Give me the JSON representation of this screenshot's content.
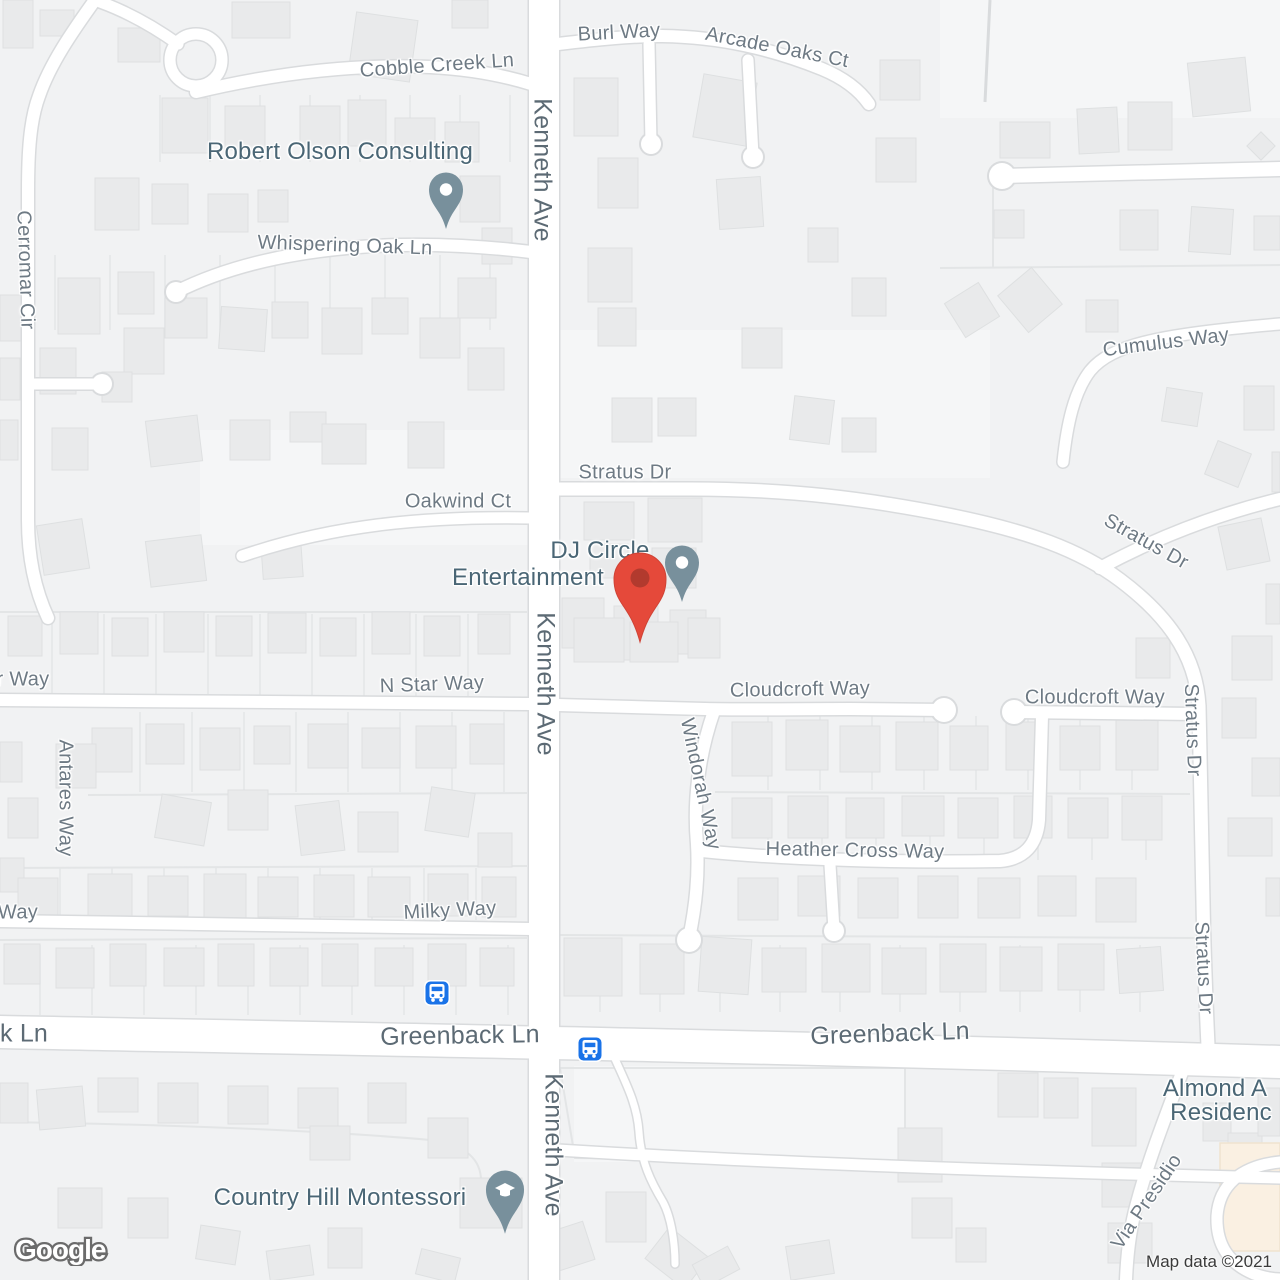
{
  "map": {
    "attribution": "Map data ©2021",
    "google_logo": "Google",
    "colors": {
      "land": "#f1f2f3",
      "light_block": "#f5f6f7",
      "road_fill": "#ffffff",
      "road_casing": "#d9dbdd",
      "parcel_line": "#e3e5e6",
      "building_fill": "#e9eaeb",
      "building_stroke": "#dee0e1",
      "commercial_fill": "#faf0e2",
      "commercial_stroke": "#f0e3cf",
      "street_label": "#6e7a84",
      "arterial_label": "#5c6a74",
      "poi_label": "#4a6675",
      "poi_pin": "#78909c",
      "red_marker": "#e5493a",
      "red_marker_inner": "#b23a2e",
      "transit_blue": "#1a73e8",
      "attribution_text": "#3a3a3a"
    },
    "street_labels": [
      {
        "text": "Burl Way",
        "x": 619,
        "y": 33,
        "rot": -3,
        "kind": "minor"
      },
      {
        "text": "Arcade Oaks Ct",
        "x": 777,
        "y": 48,
        "rot": 11,
        "kind": "minor"
      },
      {
        "text": "Cobble Creek Ln",
        "x": 437,
        "y": 66,
        "rot": -4,
        "kind": "minor"
      },
      {
        "text": "Kenneth Ave",
        "x": 542,
        "y": 170,
        "rot": 90,
        "kind": "major"
      },
      {
        "text": "Cerromar Cir",
        "x": 25,
        "y": 270,
        "rot": 88,
        "kind": "minor"
      },
      {
        "text": "Whispering Oak Ln",
        "x": 345,
        "y": 246,
        "rot": 2,
        "kind": "minor"
      },
      {
        "text": "Cumulus Way",
        "x": 1166,
        "y": 343,
        "rot": -7,
        "kind": "minor"
      },
      {
        "text": "Stratus Dr",
        "x": 625,
        "y": 473,
        "rot": 0,
        "kind": "minor"
      },
      {
        "text": "Oakwind Ct",
        "x": 458,
        "y": 502,
        "rot": 0,
        "kind": "minor"
      },
      {
        "text": "Stratus Dr",
        "x": 1146,
        "y": 542,
        "rot": 29,
        "kind": "minor"
      },
      {
        "text": "Kenneth Ave",
        "x": 545,
        "y": 684,
        "rot": 90,
        "kind": "major"
      },
      {
        "text": "N Star Way",
        "x": 432,
        "y": 685,
        "rot": -2,
        "kind": "minor"
      },
      {
        "text": "r Way",
        "x": 23,
        "y": 680,
        "rot": 0,
        "kind": "minor"
      },
      {
        "text": "Cloudcroft Way",
        "x": 800,
        "y": 690,
        "rot": -1,
        "kind": "minor"
      },
      {
        "text": "Cloudcroft Way",
        "x": 1095,
        "y": 698,
        "rot": 0,
        "kind": "minor"
      },
      {
        "text": "Stratus Dr",
        "x": 1192,
        "y": 730,
        "rot": 88,
        "kind": "minor"
      },
      {
        "text": "Antares Way",
        "x": 65,
        "y": 798,
        "rot": 90,
        "kind": "minor"
      },
      {
        "text": "Windorah Way",
        "x": 700,
        "y": 784,
        "rot": 78,
        "kind": "minor"
      },
      {
        "text": "Heather Cross Way",
        "x": 855,
        "y": 851,
        "rot": 1,
        "kind": "minor"
      },
      {
        "text": "Milky Way",
        "x": 450,
        "y": 911,
        "rot": -3,
        "kind": "minor"
      },
      {
        "text": "Way",
        "x": 18,
        "y": 913,
        "rot": 0,
        "kind": "minor"
      },
      {
        "text": "Stratus Dr",
        "x": 1203,
        "y": 968,
        "rot": 87,
        "kind": "minor"
      },
      {
        "text": "k Ln",
        "x": 24,
        "y": 1034,
        "rot": 0,
        "kind": "major"
      },
      {
        "text": "Greenback Ln",
        "x": 460,
        "y": 1036,
        "rot": -1,
        "kind": "major"
      },
      {
        "text": "Greenback Ln",
        "x": 890,
        "y": 1034,
        "rot": -2,
        "kind": "major"
      },
      {
        "text": "Kenneth Ave",
        "x": 553,
        "y": 1145,
        "rot": 90,
        "kind": "major"
      },
      {
        "text": "Via Presidio",
        "x": 1147,
        "y": 1202,
        "rot": -56,
        "kind": "minor"
      }
    ],
    "poi_labels": [
      {
        "text": "Robert Olson Consulting",
        "x": 340,
        "y": 152
      },
      {
        "text": "DJ Circle",
        "x": 600,
        "y": 551
      },
      {
        "text": "Entertainment",
        "x": 528,
        "y": 578
      },
      {
        "text": "Country Hill Montessori",
        "x": 340,
        "y": 1198
      },
      {
        "text": "Almond A",
        "x": 1215,
        "y": 1089
      },
      {
        "text": "Residenc",
        "x": 1221,
        "y": 1113
      }
    ],
    "poi_pins": [
      {
        "name": "robert-olson-consulting-pin",
        "x": 446,
        "y": 189,
        "glyph": "dot"
      },
      {
        "name": "dj-circle-entertainment-pin",
        "x": 682,
        "y": 562,
        "glyph": "dot"
      },
      {
        "name": "country-hill-montessori-pin",
        "x": 505,
        "y": 1189,
        "glyph": "graduation-cap"
      }
    ],
    "destination_marker": {
      "name": "destination-marker",
      "x": 640,
      "y": 578
    },
    "transit_stops": [
      {
        "name": "bus-stop-icon",
        "x": 437,
        "y": 993
      },
      {
        "name": "bus-stop-icon",
        "x": 590,
        "y": 1049
      }
    ]
  }
}
